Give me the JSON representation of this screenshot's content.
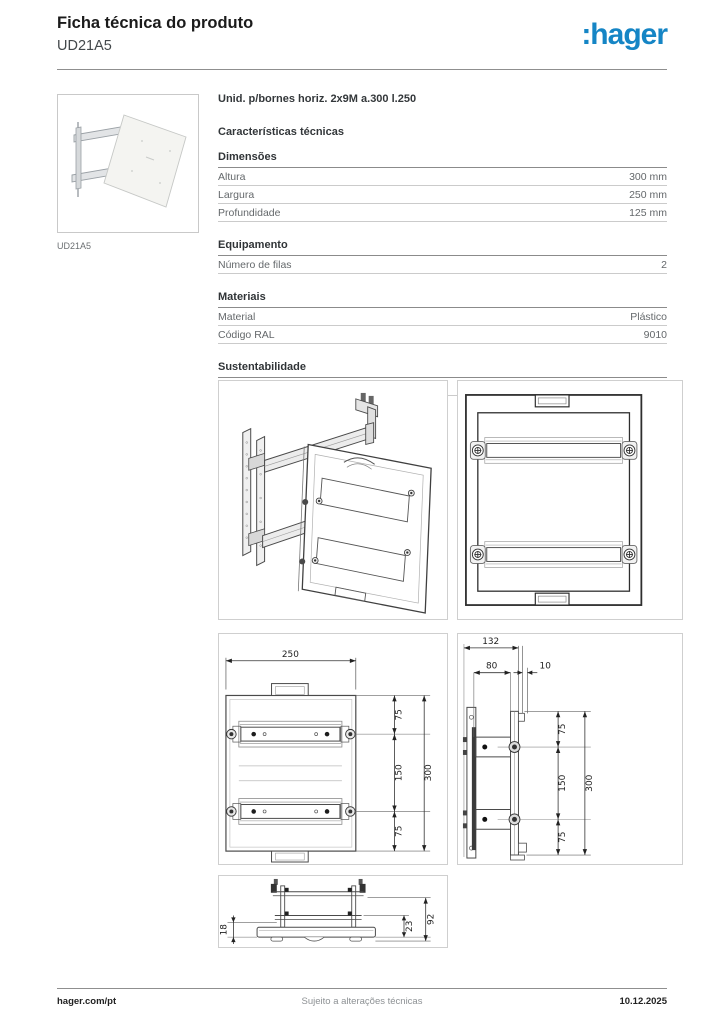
{
  "header": {
    "title": "Ficha técnica do produto",
    "product_code": "UD21A5",
    "logo_text": ":hager",
    "brand_color": "#1585c5"
  },
  "thumbnail": {
    "caption": "UD21A5"
  },
  "product": {
    "description": "Unid. p/bornes horiz. 2x9M a.300 l.250"
  },
  "characteristics": {
    "title": "Características técnicas",
    "groups": [
      {
        "title": "Dimensões",
        "rows": [
          {
            "label": "Altura",
            "value": "300 mm"
          },
          {
            "label": "Largura",
            "value": "250 mm"
          },
          {
            "label": "Profundidade",
            "value": "125 mm"
          }
        ]
      },
      {
        "title": "Equipamento",
        "rows": [
          {
            "label": "Número de filas",
            "value": "2"
          }
        ]
      },
      {
        "title": "Materiais",
        "rows": [
          {
            "label": "Material",
            "value": "Plástico"
          },
          {
            "label": "Código RAL",
            "value": "9010"
          }
        ]
      },
      {
        "title": "Sustentabilidade",
        "rows": [
          {
            "label": "Conformidade RoHs",
            "value": "Sim"
          }
        ]
      }
    ]
  },
  "images_section": {
    "title": "Imagens e esquemas"
  },
  "drawings": {
    "front_dims": {
      "width": "250",
      "top": "75",
      "middle": "150",
      "bottom": "75",
      "height": "300"
    },
    "side_dims": {
      "overall_width": "132",
      "depth": "80",
      "lip": "10",
      "top": "75",
      "middle": "150",
      "bottom": "75",
      "height": "300"
    },
    "section_dims": {
      "plate_inset": "18",
      "inner_height": "23",
      "overall_height": "92"
    }
  },
  "footer": {
    "website": "hager.com/pt",
    "note": "Sujeito a alterações técnicas",
    "date": "10.12.2025"
  }
}
